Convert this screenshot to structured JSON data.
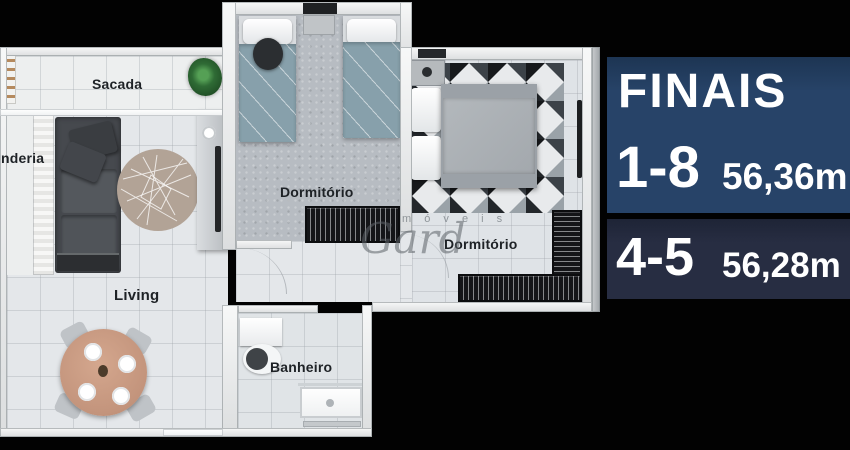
{
  "floorplan": {
    "rooms": {
      "sacada": {
        "label": "Sacada"
      },
      "laundry": {
        "label": "nderia"
      },
      "bedroom_top": {
        "label": "Dormitório"
      },
      "bedroom_right": {
        "label": "Dormitório"
      },
      "living": {
        "label": "Living"
      },
      "bathroom": {
        "label": "Banheiro"
      }
    },
    "watermark": {
      "word": "m ó v e i s",
      "script": "Gard"
    },
    "icons": {
      "plant-icon": "green-css-blob"
    }
  },
  "info_panel": {
    "title": "FINAIS",
    "rows": [
      {
        "units": "1-8",
        "area": "56,36m"
      },
      {
        "units": "4-5",
        "area": "56,28m"
      }
    ],
    "colors": {
      "row1_bg": "#274368",
      "row2_bg": "#272d42",
      "text": "#ffffff"
    }
  }
}
